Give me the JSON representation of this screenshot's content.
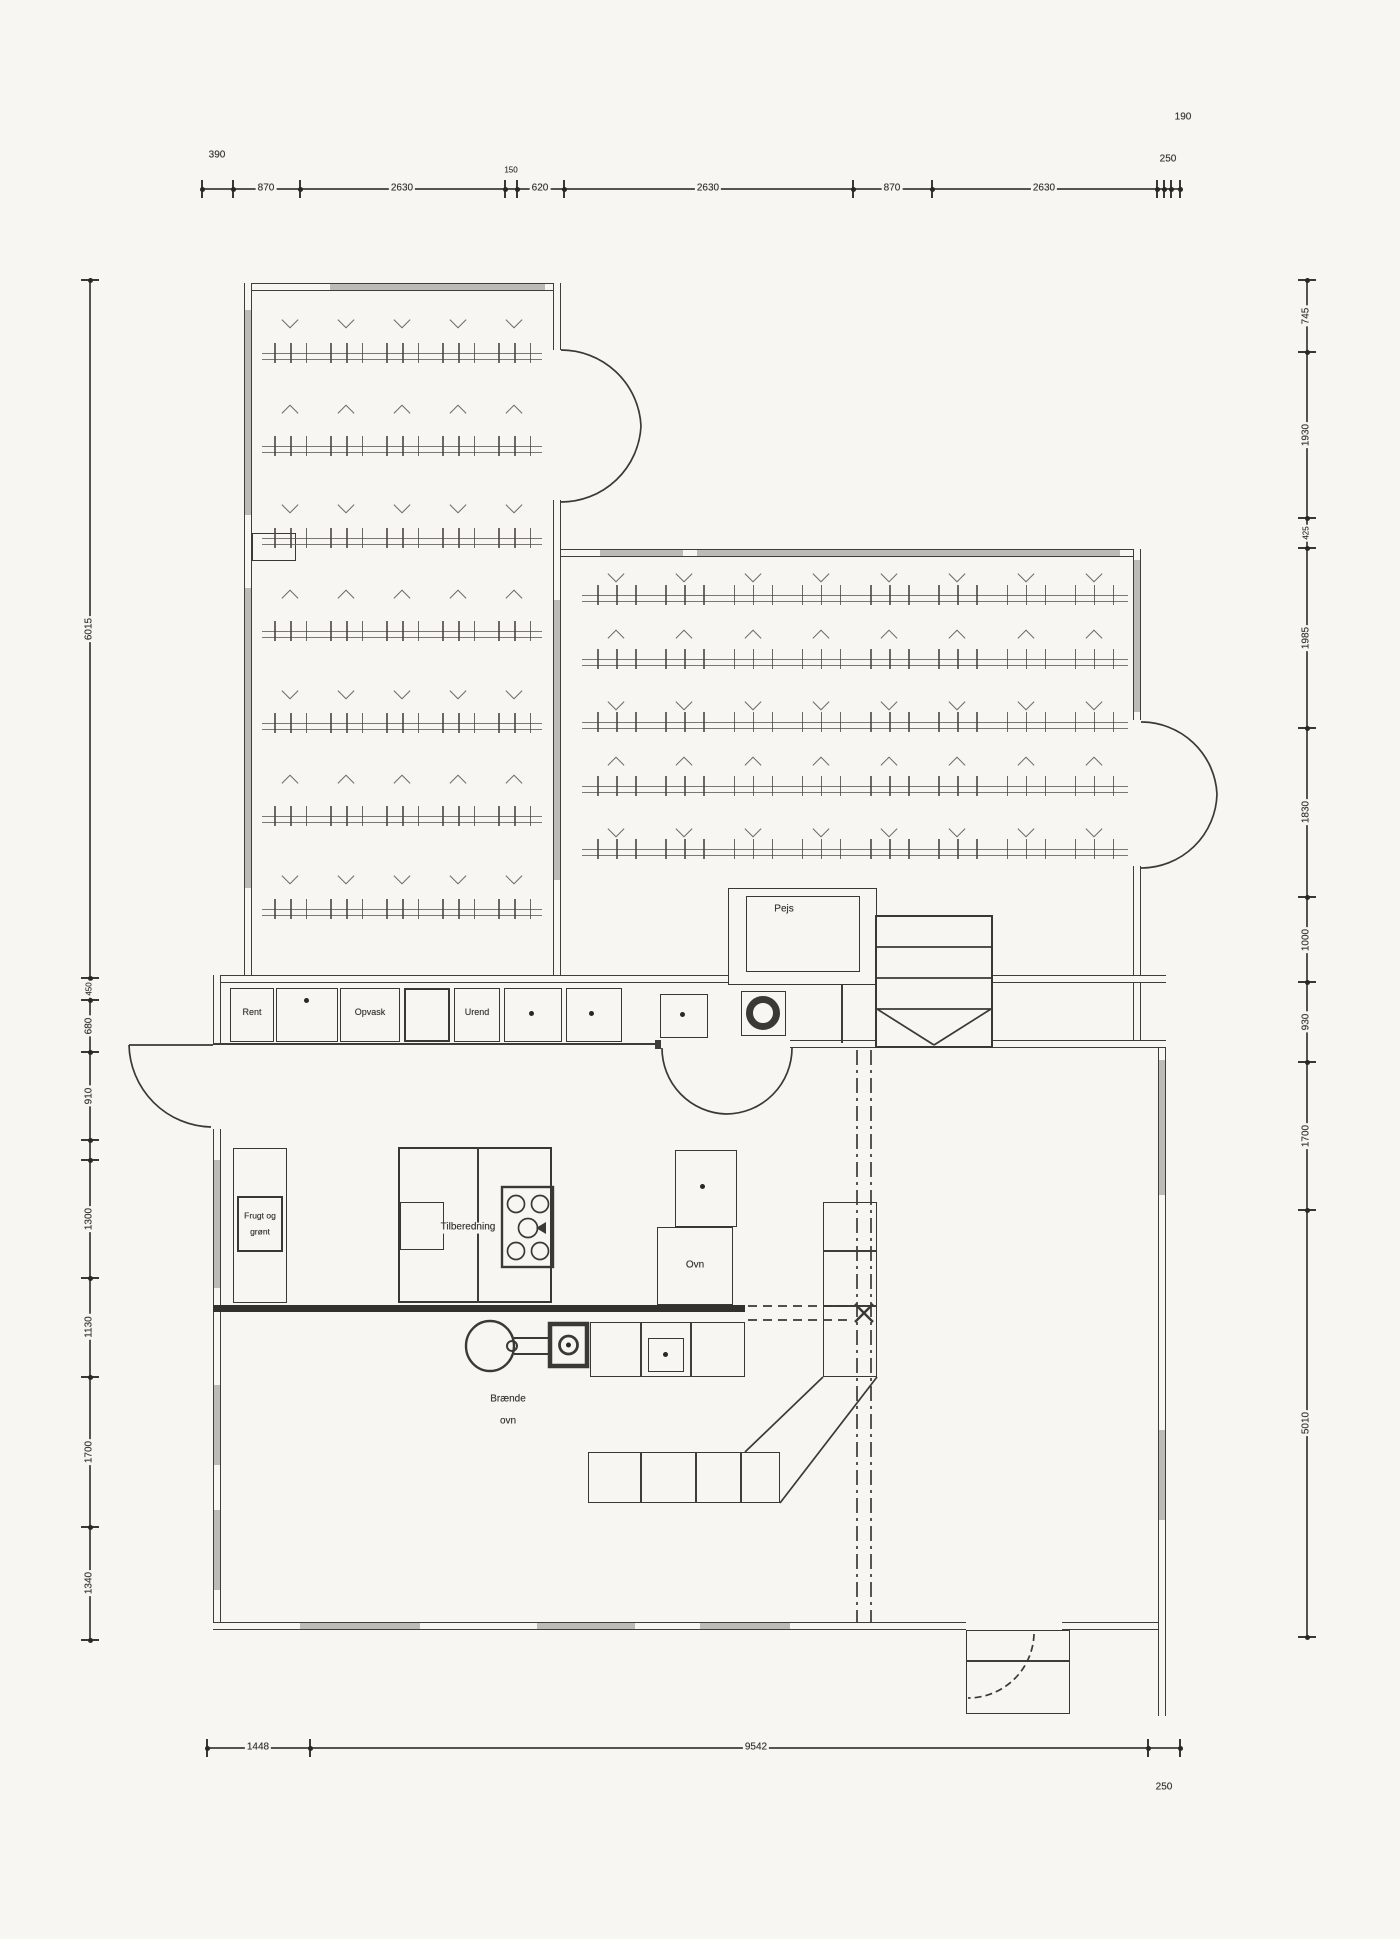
{
  "drawing": {
    "type": "floor-plan"
  },
  "dimensions": {
    "top": {
      "v390": "390",
      "v870a": "870",
      "v2630a": "2630",
      "v150": "150",
      "v620": "620",
      "v2630b": "2630",
      "v870b": "870",
      "v2630c": "2630",
      "v250": "250",
      "v190": "190"
    },
    "left": {
      "v6015": "6015",
      "v450": "450",
      "v680": "680",
      "v910": "910",
      "v1300": "1300",
      "v1130": "1130",
      "v1700": "1700",
      "v1340": "1340"
    },
    "right": {
      "v745": "745",
      "v1930": "1930",
      "v425": "425",
      "v1985": "1985",
      "v1830": "1830",
      "v1000": "1000",
      "v930": "930",
      "v1700": "1700",
      "v5010": "5010"
    },
    "bottom": {
      "v1448": "1448",
      "v9542": "9542",
      "v250": "250"
    }
  },
  "labels": {
    "rent": "Rent",
    "opvask": "Opvask",
    "urend": "Urend",
    "pejs": "Pejs",
    "frugt1": "Frugt og",
    "frugt2": "grønt",
    "tilberedning": "Tilberedning",
    "ovn": "Ovn",
    "braende1": "Brænde",
    "braende2": "ovn"
  },
  "rooms": {
    "left_seating": {
      "rows": 7,
      "cols": 5
    },
    "right_seating": {
      "rows": 5,
      "cols": 8
    }
  },
  "colors": {
    "line": "#3f3d39",
    "window_fill": "#bdbbb5",
    "paper": "#f7f6f2",
    "dark_wall": "#33312d"
  }
}
